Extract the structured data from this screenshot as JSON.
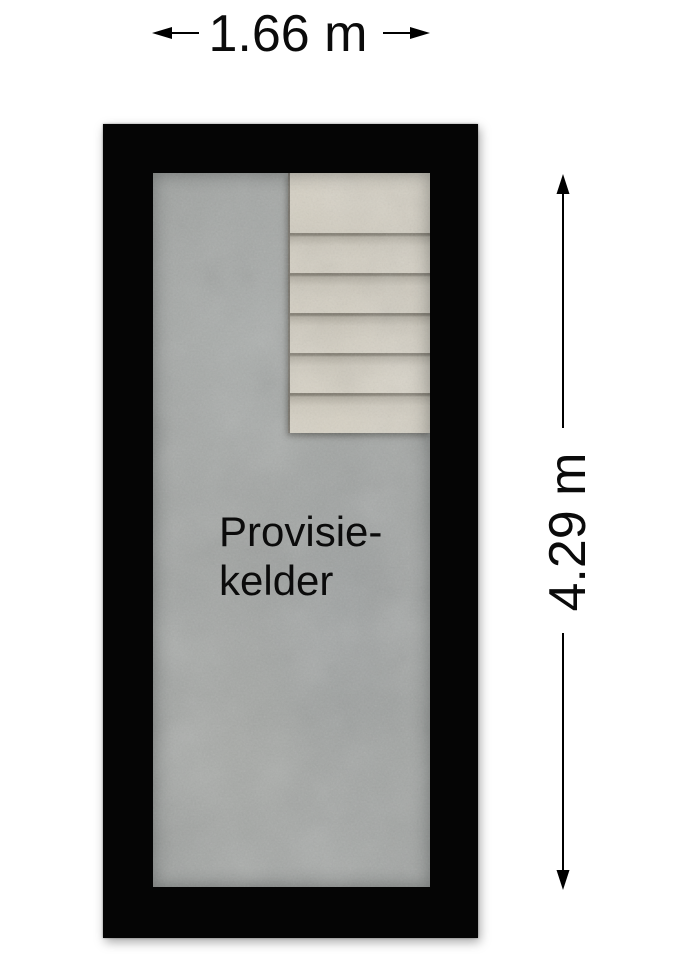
{
  "dimensions": {
    "width": {
      "label": "1.66 m"
    },
    "height": {
      "label": "4.29 m"
    }
  },
  "room": {
    "name_line1": "Provisie-",
    "name_line2": "kelder"
  },
  "stairs": {
    "step_count": 6
  },
  "colors": {
    "background": "#ffffff",
    "wall": "#050505",
    "floor": "#a2a5a3",
    "stair_tread": "#d5d0c3",
    "stair_shadow": "#7f7a6e",
    "text": "#0b0b0b"
  }
}
